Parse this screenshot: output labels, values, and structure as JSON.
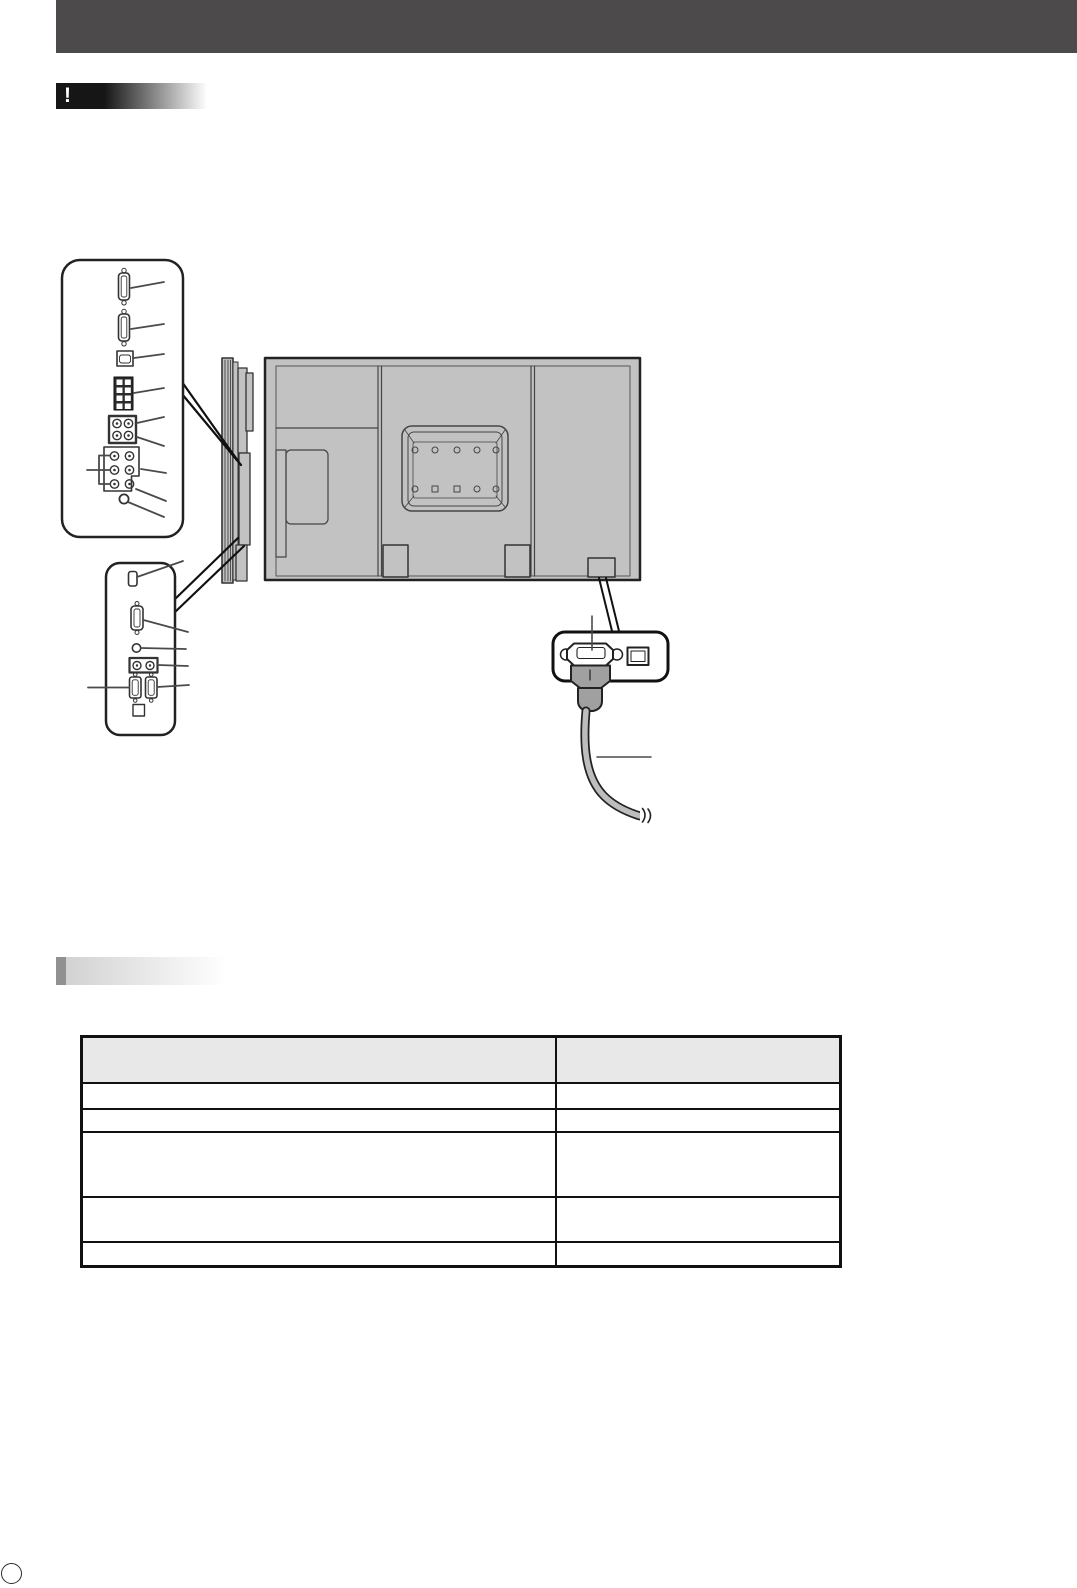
{
  "banners": {
    "caution_mark": "!",
    "caution_title": "",
    "section_title": ""
  },
  "diagram": {
    "upper_terminal_callout_icons": [
      "dsub-connector-icon",
      "dsub-connector-icon",
      "optical-square-connector-icon",
      "terminal-block-icon",
      "rca-jack-grid-2x2-icon",
      "rca-jack-grid-3x2-icon",
      "mini-jack-icon"
    ],
    "lower_terminal_callout_icons": [
      "hdmi-connector-icon",
      "dsub-connector-icon",
      "mini-jack-icon",
      "rca-jack-pair-icon",
      "dsub-connector-icon",
      "dsub-connector-icon",
      "switch-outline-icon"
    ],
    "power_callout_icons": [
      "ac-inlet-icon",
      "main-power-switch-icon",
      "power-plug-icon",
      "power-cord-icon"
    ],
    "parts": [
      "display-side-view",
      "display-rear-view",
      "vesa-mount-recess",
      "stand-attachment-points",
      "ac-inlet-location"
    ]
  },
  "table": {
    "header": [
      "",
      ""
    ],
    "rows": [
      [
        "",
        ""
      ],
      [
        "",
        ""
      ],
      [
        "",
        ""
      ],
      [
        "",
        ""
      ],
      [
        "",
        ""
      ]
    ]
  },
  "footer": {
    "page_number": ""
  },
  "colors": {
    "header_bar": "#4d4a4b",
    "caution_gradient_start": "#161616",
    "section_accent": "#919191",
    "section_gradient_start": "#d2d2d2",
    "diagram_fill": "#c2c2c2",
    "outline": "#222222",
    "table_header_bg": "#e8e8e8"
  }
}
